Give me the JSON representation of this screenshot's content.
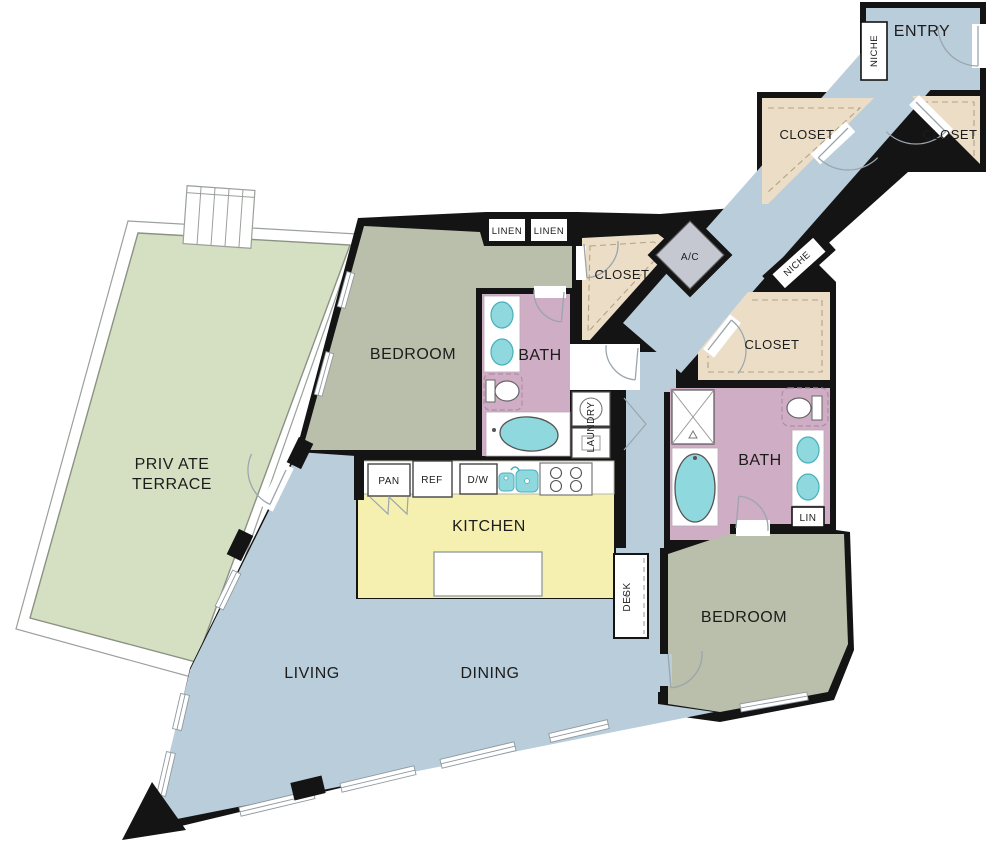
{
  "plan": {
    "type": "apartment-floor-plan",
    "rooms": {
      "entry": {
        "label": "ENTRY"
      },
      "niche_entry": {
        "label": "NICHE"
      },
      "niche_hall": {
        "label": "NICHE"
      },
      "closet_entry_left": {
        "label": "CLOSET"
      },
      "closet_entry_right": {
        "label": "CLOSET"
      },
      "ac": {
        "label": "A/C"
      },
      "linen_left": {
        "label": "LINEN"
      },
      "linen_right": {
        "label": "LINEN"
      },
      "closet_primary": {
        "label": "CLOSET"
      },
      "bedroom_primary": {
        "label": "BEDROOM"
      },
      "bath_primary": {
        "label": "BATH"
      },
      "laundry": {
        "label": "LAUNDRY"
      },
      "pantry": {
        "label": "PAN"
      },
      "refrigerator": {
        "label": "REF"
      },
      "dishwasher": {
        "label": "D/W"
      },
      "kitchen": {
        "label": "KITCHEN"
      },
      "desk": {
        "label": "DESK"
      },
      "closet_secondary": {
        "label": "CLOSET"
      },
      "bath_secondary": {
        "label": "BATH"
      },
      "linen_secondary": {
        "label": "LIN"
      },
      "bedroom_secondary": {
        "label": "BEDROOM"
      },
      "living": {
        "label": "LIVING"
      },
      "dining": {
        "label": "DINING"
      },
      "terrace": {
        "label_line1": "PRIV ATE",
        "label_line2": "TERRACE"
      }
    },
    "colors": {
      "hall_blue": "#b9cdda",
      "bedroom_sage": "#b9bfaa",
      "terrace_green": "#d5e0c3",
      "bath_pink": "#cfadc4",
      "kitchen_yellow": "#f5efb0",
      "closet_tan": "#ecddc6",
      "ac_gray": "#c5c8d0",
      "fixture_teal": "#8ed8de",
      "wall_black": "#141414"
    }
  }
}
